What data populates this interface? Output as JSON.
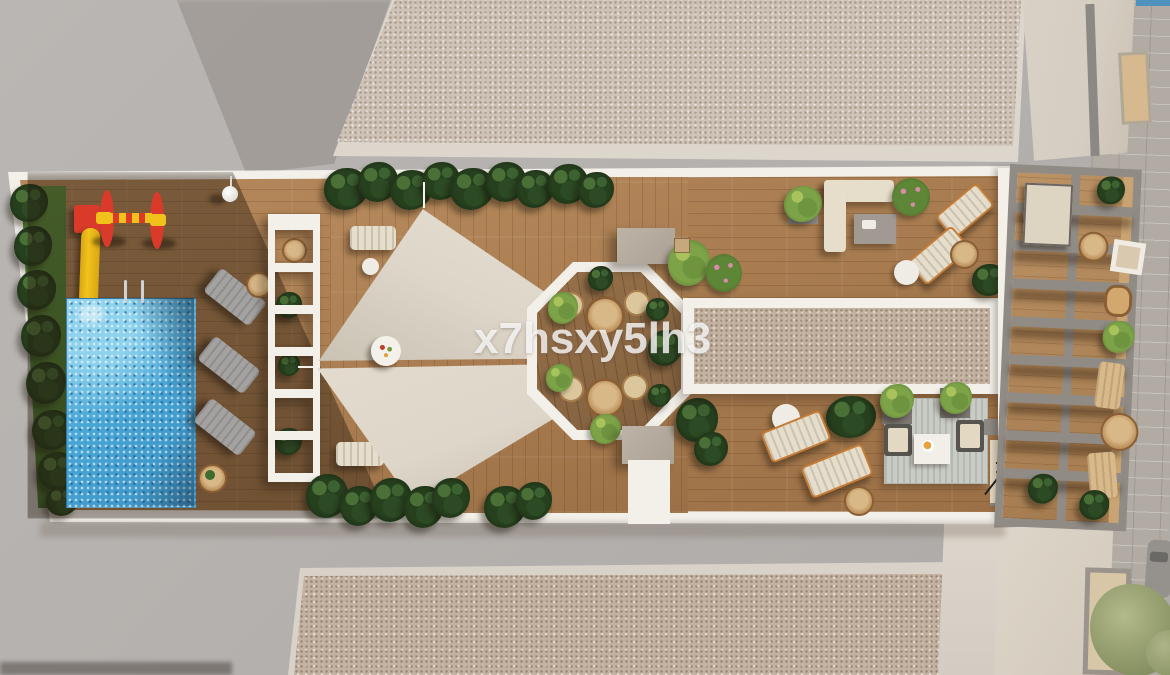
{
  "watermark": {
    "text": "x7hsxy5lh3"
  },
  "scene": {
    "type": "architectural 3d render",
    "view": "top-down aerial of a residential rooftop / pool terrace",
    "areas": [
      "children-playground",
      "swimming-pool",
      "pool-loungers",
      "white-slat-pergola",
      "shade-sails",
      "octagon-dining-gazebo",
      "skylight-gravel-strip",
      "lounge-sofa-corner",
      "sunbed-pairs",
      "outdoor-rug-lounge",
      "stairwell",
      "slatted-pergola-deck",
      "street-brick-pavement",
      "neighbor-rooftops"
    ]
  },
  "colors": {
    "concrete": "#b5b1ae",
    "concrete_shade": "#a29d98",
    "gravel": "#cfc3b7",
    "gravel_inner": "#c4b2a1",
    "frame_white": "#f3f0ea",
    "wood": "#9c7046",
    "wood_light": "#b68a5c",
    "wood_octagon": "#82603e",
    "pool_blue": "#47a6d6",
    "pool_light": "#8ed2ee",
    "sail": "#ddd6c9",
    "sail_dark": "#c9c1b2",
    "plant_dark": "#16240f",
    "plant_mid": "#26401e",
    "plant_light": "#7ca347",
    "grass": "#4a7c33",
    "play_red": "#d93a2a",
    "play_yellow": "#f2c21c",
    "lounger_gray": "#a3a2a0",
    "lounger_cream": "#e6ddca",
    "frame_orange": "#c47c36",
    "pergola_gray": "#918b85",
    "brick": "#b2aba3",
    "building_cream": "#d5cdc1",
    "rug_gray": "#c9ccc5",
    "stair_floor": "#e6dbc6"
  }
}
